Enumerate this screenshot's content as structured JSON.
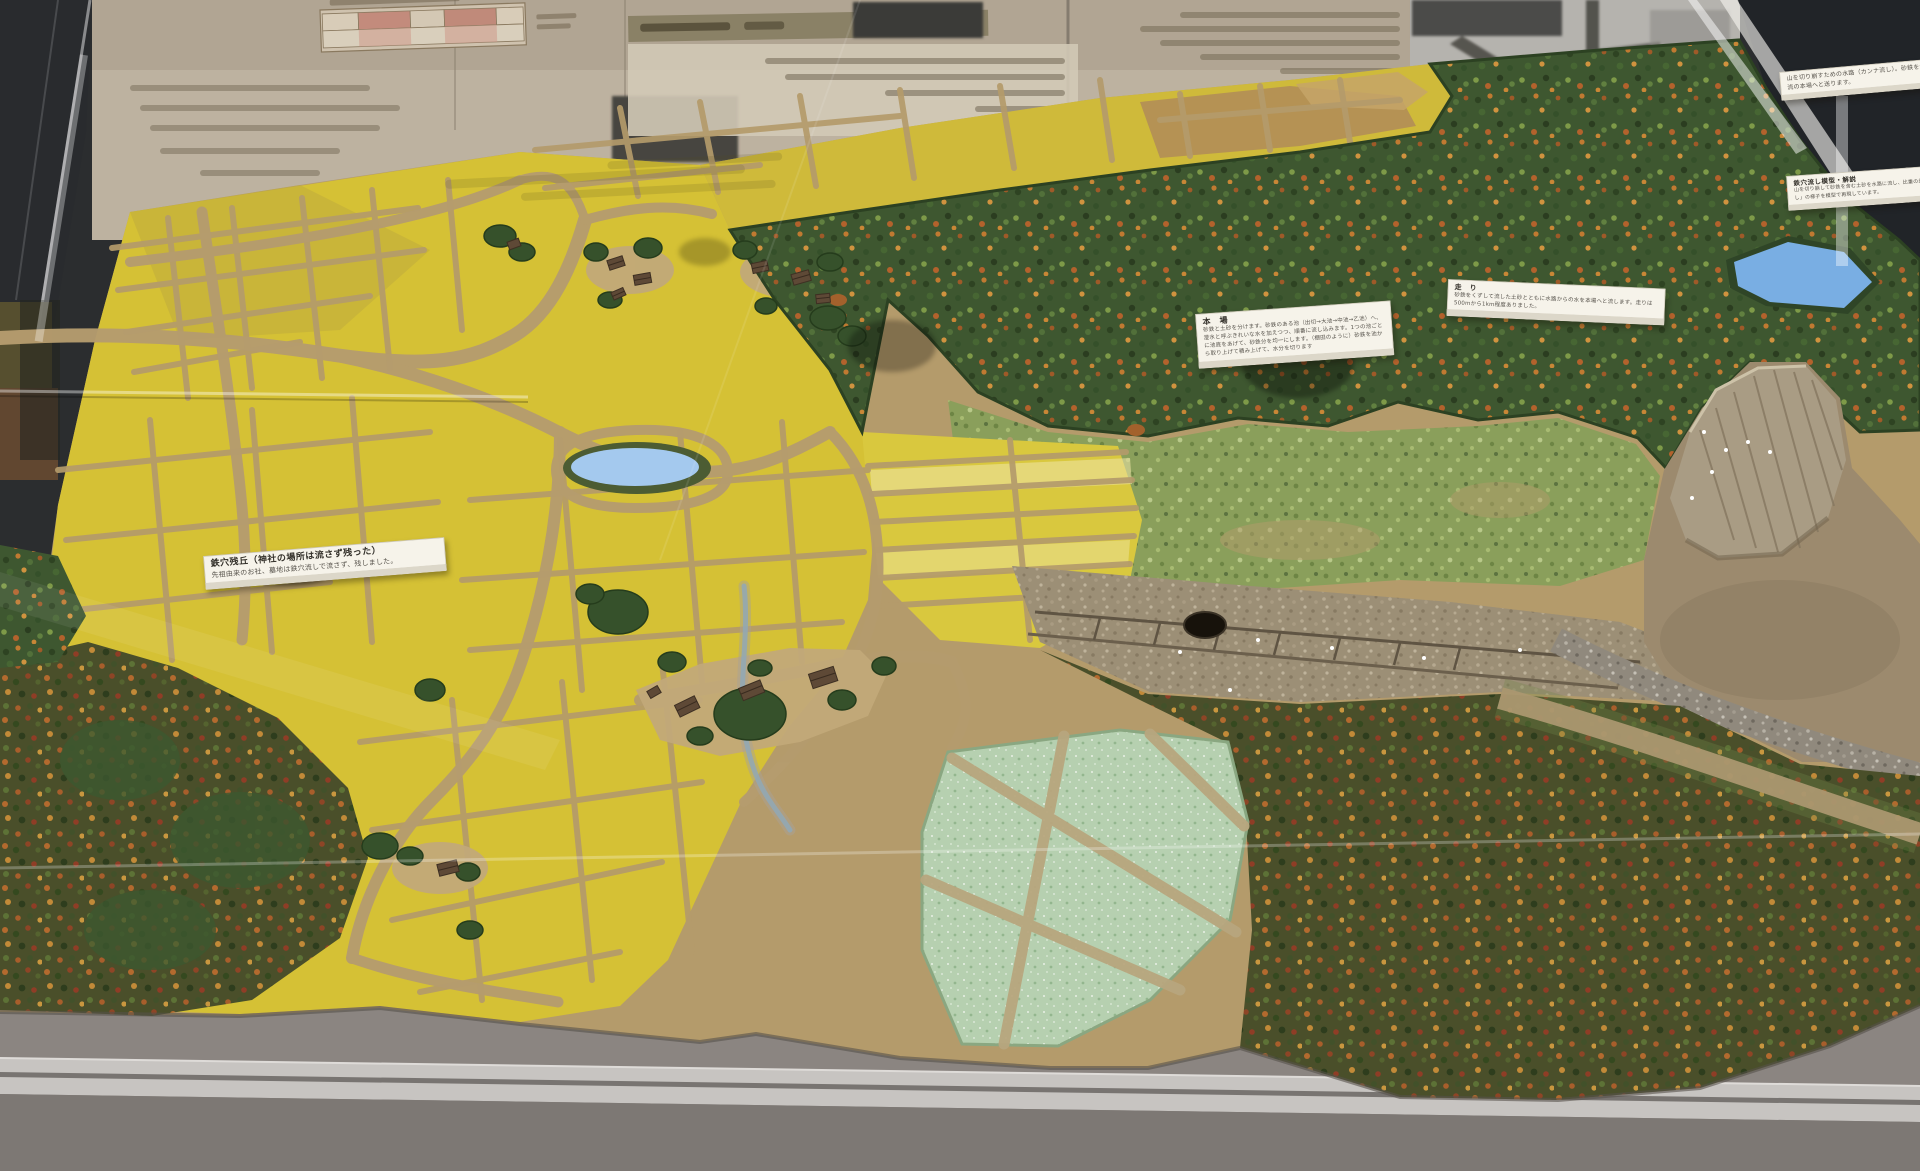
{
  "exhibit": {
    "labels": {
      "zankyu": {
        "title": "鉄穴残丘（神社の場所は流さず残った）",
        "body": "先祖由来のお社、墓地は鉄穴流しで流さず、残しました。"
      },
      "honba": {
        "title": "本　場",
        "body": "砂鉄と土砂を分けます。砂鉄のある池（出切→大池→中池→乙池）へ、澄水と呼ぶきれいな水を加えつつ、順番に流し込みます。1つの池ごとに池底をあげて、砂鉄分を均一にします。（棚田のように）砂鉄を池から取り上げて積み上げて、水分を切ります"
      },
      "hashiri": {
        "title": "走　り",
        "body": "砂鉄をくずして流した土砂とともに水路からの水を本場へと流します。走りは500mから1km程度ありました。"
      },
      "cliff_note": {
        "body": "山を切り崩すための水路（カンナ流し）。砂鉄を含む土砂を、水の流れで下流の本場へと送ります。"
      },
      "model_caption": {
        "title": "鉄穴流し模型・解説",
        "body": "山を切り崩して砂鉄を含む土砂を水路に流し、比重の差で砂鉄をえり分けた「鉄穴流し」の様子を模型で再現しています。"
      }
    },
    "colors": {
      "field_yellow": "#d5c135",
      "forest_green": "#3e5730",
      "autumn_orange": "#b36a2e",
      "pond_blue": "#9cc5ec",
      "dirt_tan": "#b49b6b",
      "platform_gray": "#8b8581",
      "rail_gray": "#c7c4c1",
      "label_white": "#f6f3ea",
      "case_dark": "#212428"
    }
  }
}
